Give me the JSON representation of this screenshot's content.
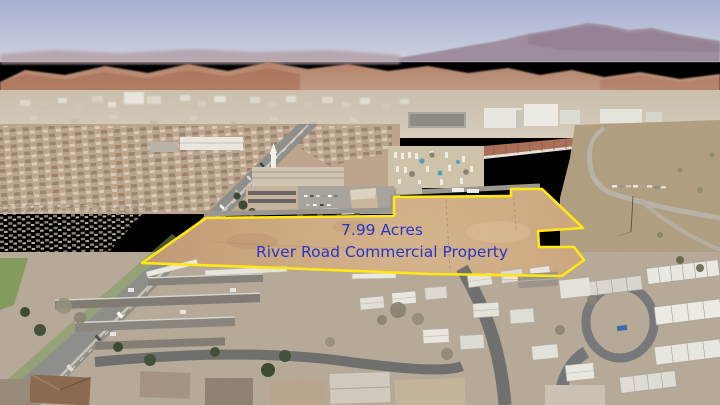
{
  "overlay": {
    "line1": "7.99 Acres",
    "line2": "River Road Commercial Property",
    "text_color": "#2836c8",
    "boundary_color": "#ffe714"
  }
}
